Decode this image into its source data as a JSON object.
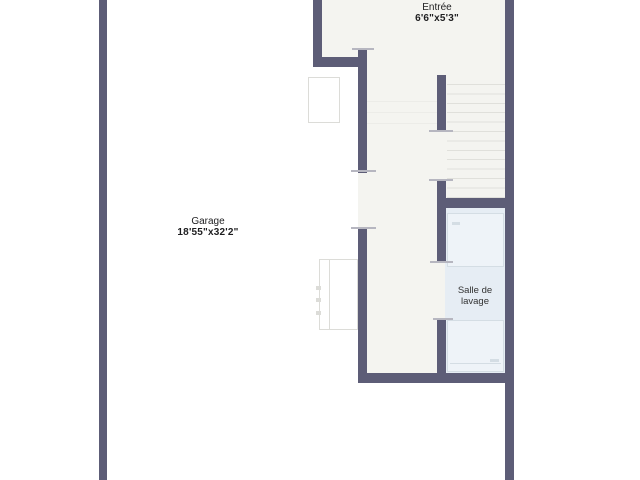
{
  "title": "Floor plan",
  "colors": {
    "bg": "#ffffff",
    "wall": "#5d5d77",
    "floor": "#f4f4f0",
    "laundry-floor": "#e6edf4",
    "appliance": "#eef3f8",
    "appliance-border": "#d4dde4",
    "tread": "#e0e0db",
    "tread-faint": "#ecece8",
    "jamb": "#b6b6c0",
    "object-border": "#dcdcd8",
    "text": "#1d1d1f"
  },
  "rooms": {
    "entree": {
      "label": "Entrée",
      "dimensions": "6'6\"x5'3\""
    },
    "garage": {
      "label": "Garage",
      "dimensions": "18'55\"x32'2\""
    },
    "laundry": {
      "label": "Salle de lavage"
    }
  }
}
